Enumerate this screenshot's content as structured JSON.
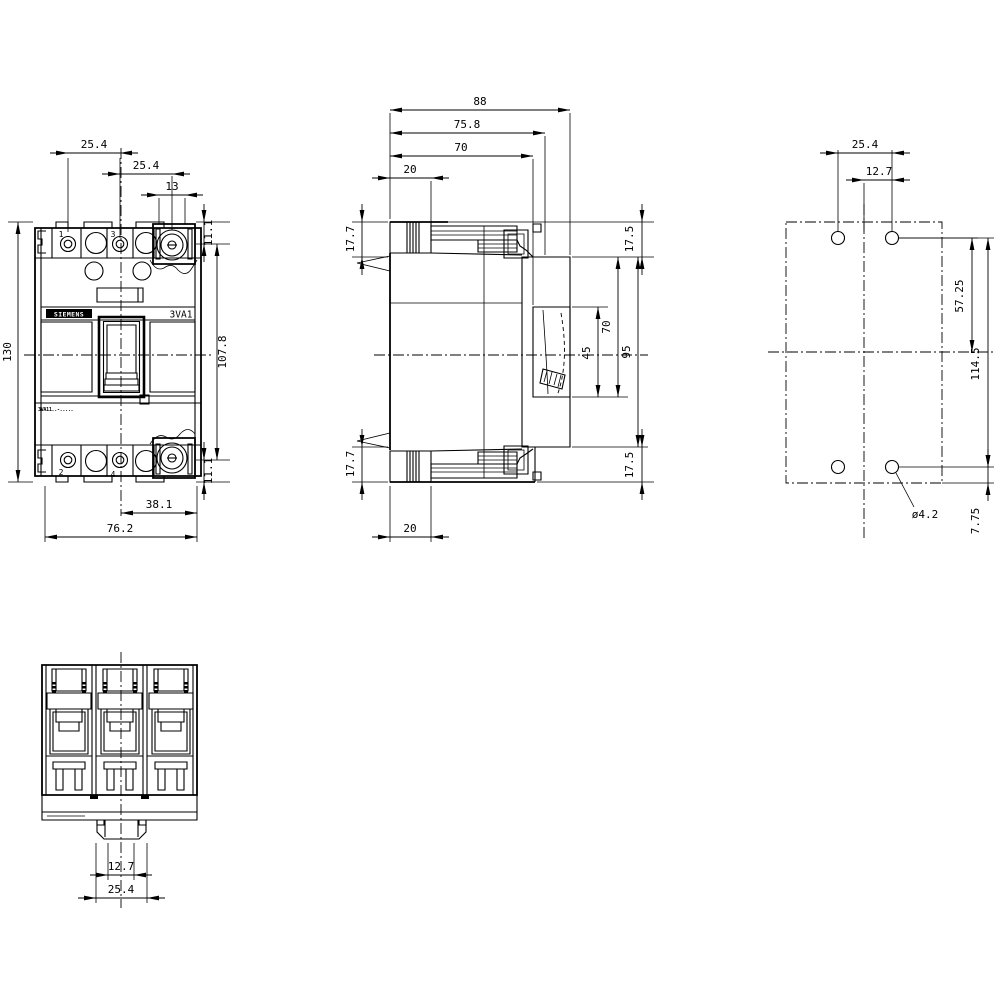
{
  "drawing_title": "3VA1 molded case circuit breaker dimension drawing",
  "labels": {
    "brand": "SIEMENS",
    "product": "3VA1",
    "type_code": "3VA11..-.....",
    "terminal_1": "1",
    "terminal_3": "3",
    "terminal_2": "2",
    "terminal_4": "4"
  },
  "dims": {
    "front": {
      "pitch1": "25.4",
      "pitch2": "25.4",
      "term_w": "13",
      "off_top": "11.1",
      "height": "130",
      "inner_h": "107.8",
      "off_bot": "11.1",
      "half_w": "38.1",
      "width": "76.2"
    },
    "side": {
      "depth_max": "88",
      "depth_cover": "75.8",
      "depth_case": "70",
      "term_d_top": "20",
      "term_h_top": "17.7",
      "front_top": "17.5",
      "toggle": "45",
      "cutout": "70",
      "escutcheon": "95",
      "front_bot": "17.5",
      "term_h_bot": "17.7",
      "term_d_bot": "20"
    },
    "drill": {
      "pitch_x": "25.4",
      "half_x": "12.7",
      "half_y": "57.25",
      "pitch_y": "114.5",
      "hole_dia": "ø4.2",
      "edge": "7.75"
    },
    "bottom": {
      "inner": "12.7",
      "outer": "25.4"
    }
  }
}
